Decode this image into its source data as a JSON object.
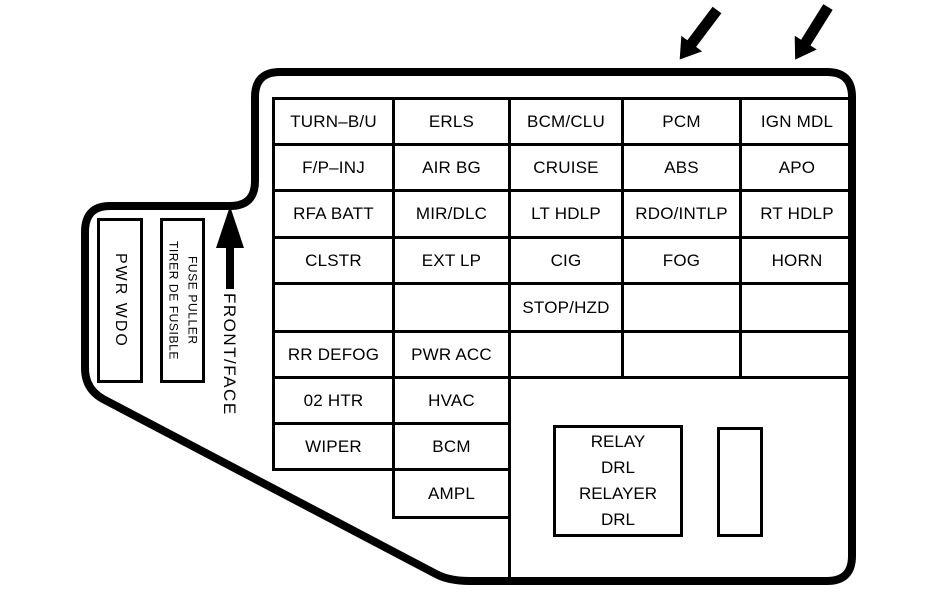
{
  "colors": {
    "ink": "#000000",
    "paper": "#ffffff"
  },
  "side_panel": {
    "pwr_wdo_label": "PWR WDO",
    "fuse_puller_line1": "FUSE PULLER",
    "fuse_puller_line2": "TIRER DE FUSIBLE",
    "front_face_label": "FRONT/FACE"
  },
  "fuse_grid": {
    "rows": [
      [
        "TURN–B/U",
        "ERLS",
        "BCM/CLU",
        "PCM",
        "IGN MDL"
      ],
      [
        "F/P–INJ",
        "AIR BG",
        "CRUISE",
        "ABS",
        "APO"
      ],
      [
        "RFA BATT",
        "MIR/DLC",
        "LT HDLP",
        "RDO/INTLP",
        "RT HDLP"
      ],
      [
        "CLSTR",
        "EXT LP",
        "CIG",
        "FOG",
        "HORN"
      ],
      [
        "",
        "",
        "STOP/HZD",
        "",
        ""
      ],
      [
        "RR DEFOG",
        "PWR ACC",
        "",
        "",
        ""
      ],
      [
        "02 HTR",
        "HVAC"
      ],
      [
        "WIPER",
        "BCM"
      ],
      [
        "AMPL"
      ]
    ]
  },
  "relay_box": {
    "line1": "RELAY",
    "line2": "DRL",
    "line3": "RELAYER",
    "line4": "DRL"
  }
}
